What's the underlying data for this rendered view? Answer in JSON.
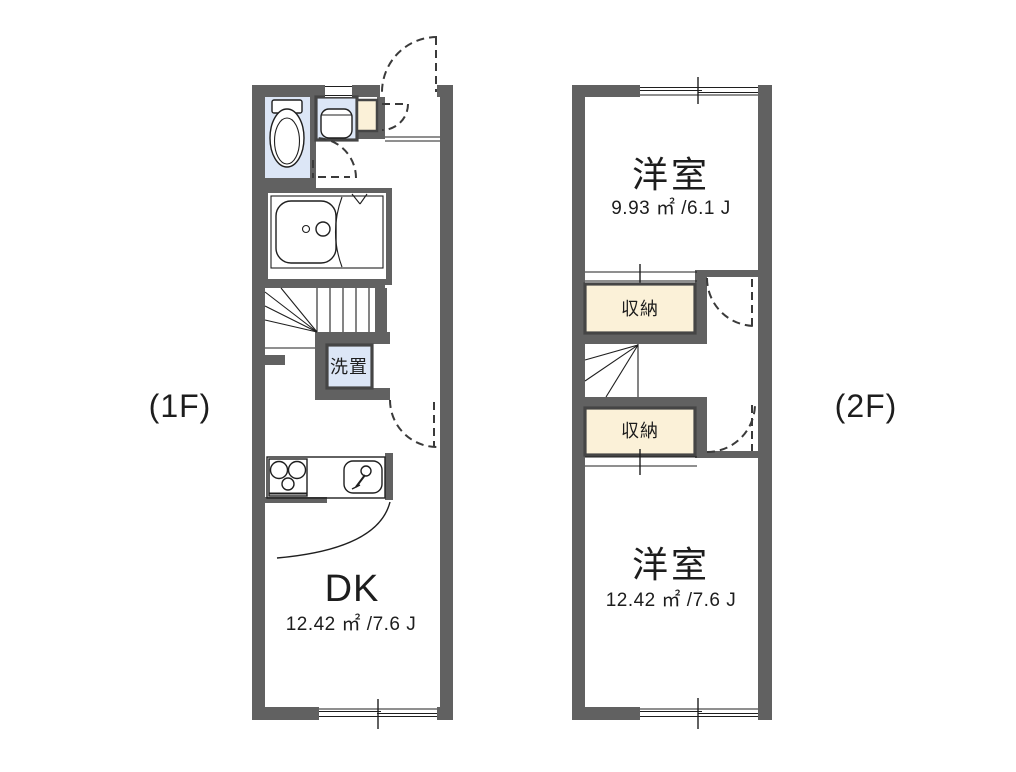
{
  "title": "apartment-floorplan",
  "colors": {
    "wall": "#616161",
    "fixture": "#dce6f6",
    "storage": "#fbf1d8",
    "line": "#1f1f1f",
    "frame": "#454545",
    "text": "#1d1d1d"
  },
  "floor1": {
    "label": "(1F)",
    "room_dk": {
      "name": "DK",
      "area": "12.42 ㎡ /7.6 J"
    },
    "laundry_label": "洗置"
  },
  "floor2": {
    "label": "(2F)",
    "room_top": {
      "name": "洋室",
      "area": "9.93 ㎡ /6.1 J"
    },
    "room_bottom": {
      "name": "洋室",
      "area": "12.42 ㎡ /7.6 J"
    },
    "closet_top_label": "収納",
    "closet_bottom_label": "収納"
  }
}
